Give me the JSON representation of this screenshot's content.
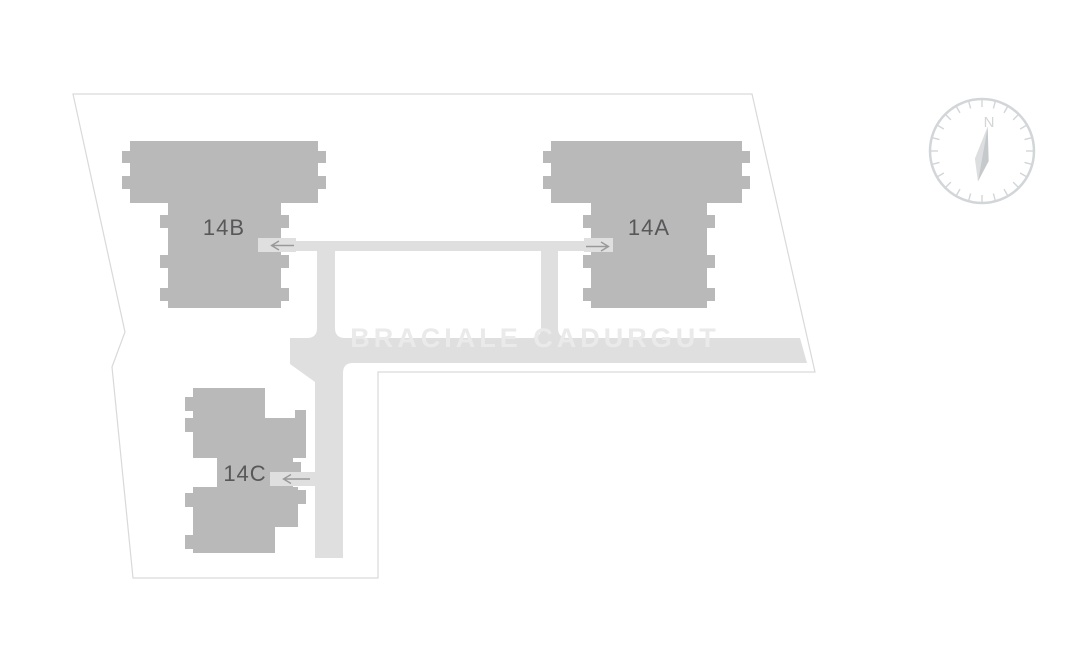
{
  "watermark": {
    "text": "BRACIALE CADURGUT"
  },
  "buildings": [
    {
      "id": "14A",
      "label": "14A"
    },
    {
      "id": "14B",
      "label": "14B"
    },
    {
      "id": "14C",
      "label": "14C"
    }
  ],
  "compass": {
    "north_label": "N"
  },
  "icons": {
    "entrance_arrow_14b": "arrow-left",
    "entrance_arrow_14a": "arrow-right",
    "entrance_arrow_14c": "arrow-left",
    "compass_rose": "compass-north-needle"
  },
  "colors": {
    "background": "#ffffff",
    "building": "#b9b9b9",
    "road": "#dfdfdf",
    "boundary": "#d9d9d9",
    "building_label": "#58585a",
    "arrow": "#999999",
    "watermark": "#eaeaea",
    "compass": "#d2d6d8",
    "needle_light": "#dcdedf",
    "needle_dark": "#c6c9cb"
  }
}
